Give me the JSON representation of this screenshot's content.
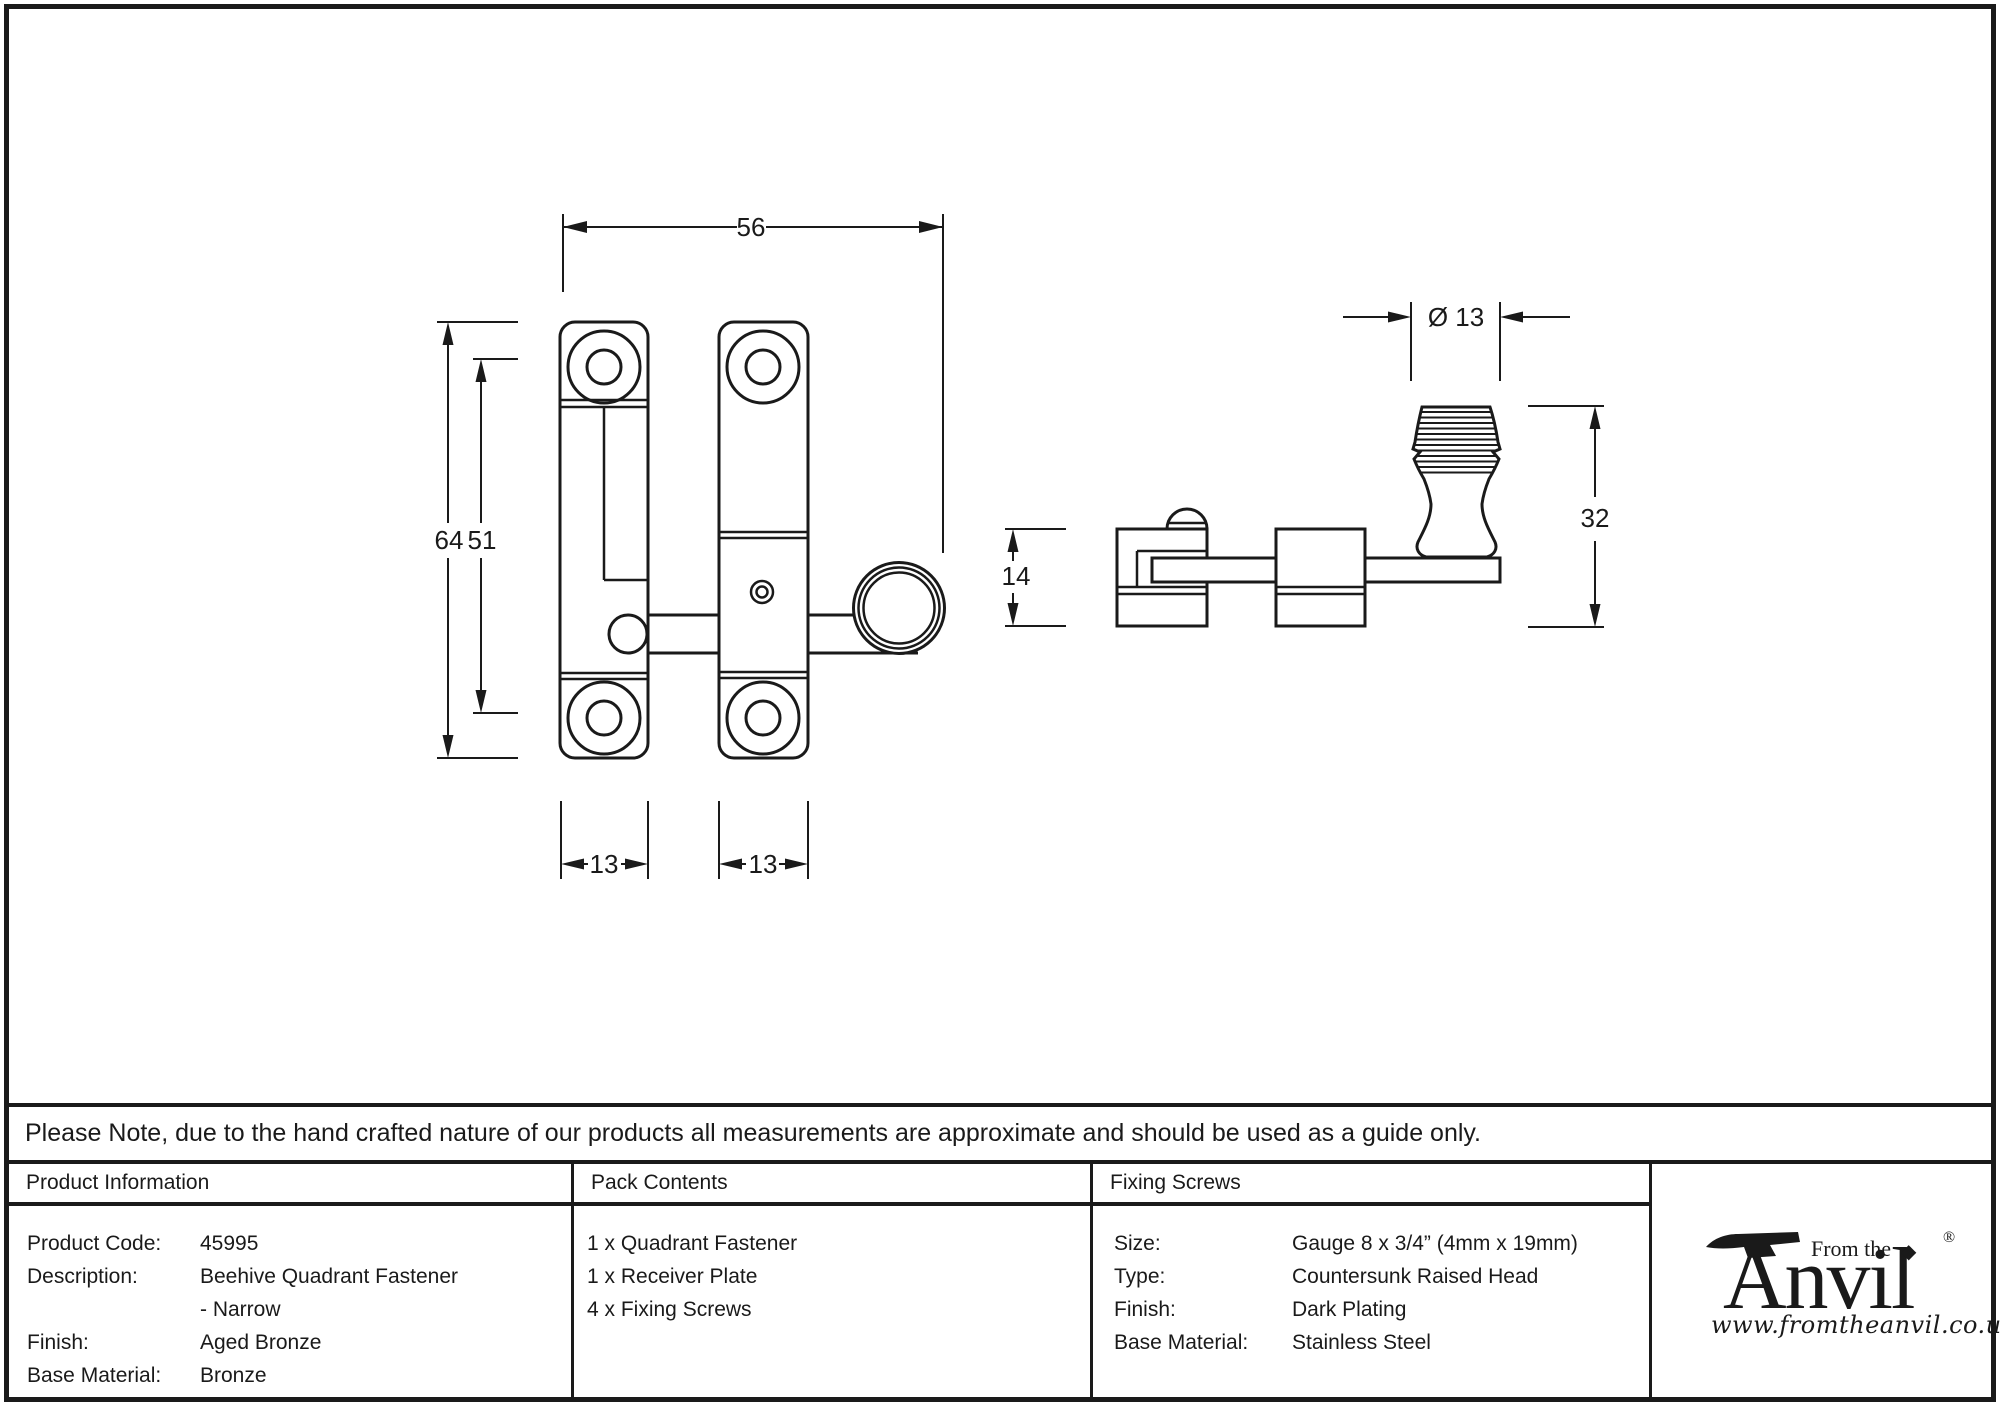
{
  "note": "Please Note, due to the hand crafted nature of our products all measurements are approximate and should be used as a guide only.",
  "drawing": {
    "front": {
      "width": "56",
      "height_outer": "64",
      "height_inner": "51",
      "plate1_width": "13",
      "plate2_width": "13"
    },
    "side": {
      "knob_diameter": "Ø 13",
      "height": "32",
      "depth": "14"
    }
  },
  "table": {
    "product_information": {
      "header": "Product Information",
      "rows": [
        {
          "label": "Product Code:",
          "value": "45995"
        },
        {
          "label": "Description:",
          "value": "Beehive Quadrant Fastener"
        },
        {
          "label": "",
          "value": "- Narrow"
        },
        {
          "label": "Finish:",
          "value": "Aged Bronze"
        },
        {
          "label": "Base Material:",
          "value": "Bronze"
        }
      ]
    },
    "pack_contents": {
      "header": "Pack Contents",
      "items": [
        "1 x Quadrant Fastener",
        "1 x Receiver Plate",
        "4 x Fixing Screws"
      ]
    },
    "fixing_screws": {
      "header": "Fixing Screws",
      "rows": [
        {
          "label": "Size:",
          "value": "Gauge 8 x 3/4” (4mm x 19mm)"
        },
        {
          "label": "Type:",
          "value": "Countersunk Raised Head"
        },
        {
          "label": "Finish:",
          "value": "Dark Plating"
        },
        {
          "label": "Base Material:",
          "value": "Stainless Steel"
        }
      ]
    }
  },
  "logo": {
    "from_the": "From the",
    "diamond": "◆",
    "word": "Anvil",
    "registered": "®",
    "website": "www.fromtheanvil.co.uk"
  },
  "colors": {
    "line": "#1a1a1a",
    "background": "#ffffff"
  }
}
